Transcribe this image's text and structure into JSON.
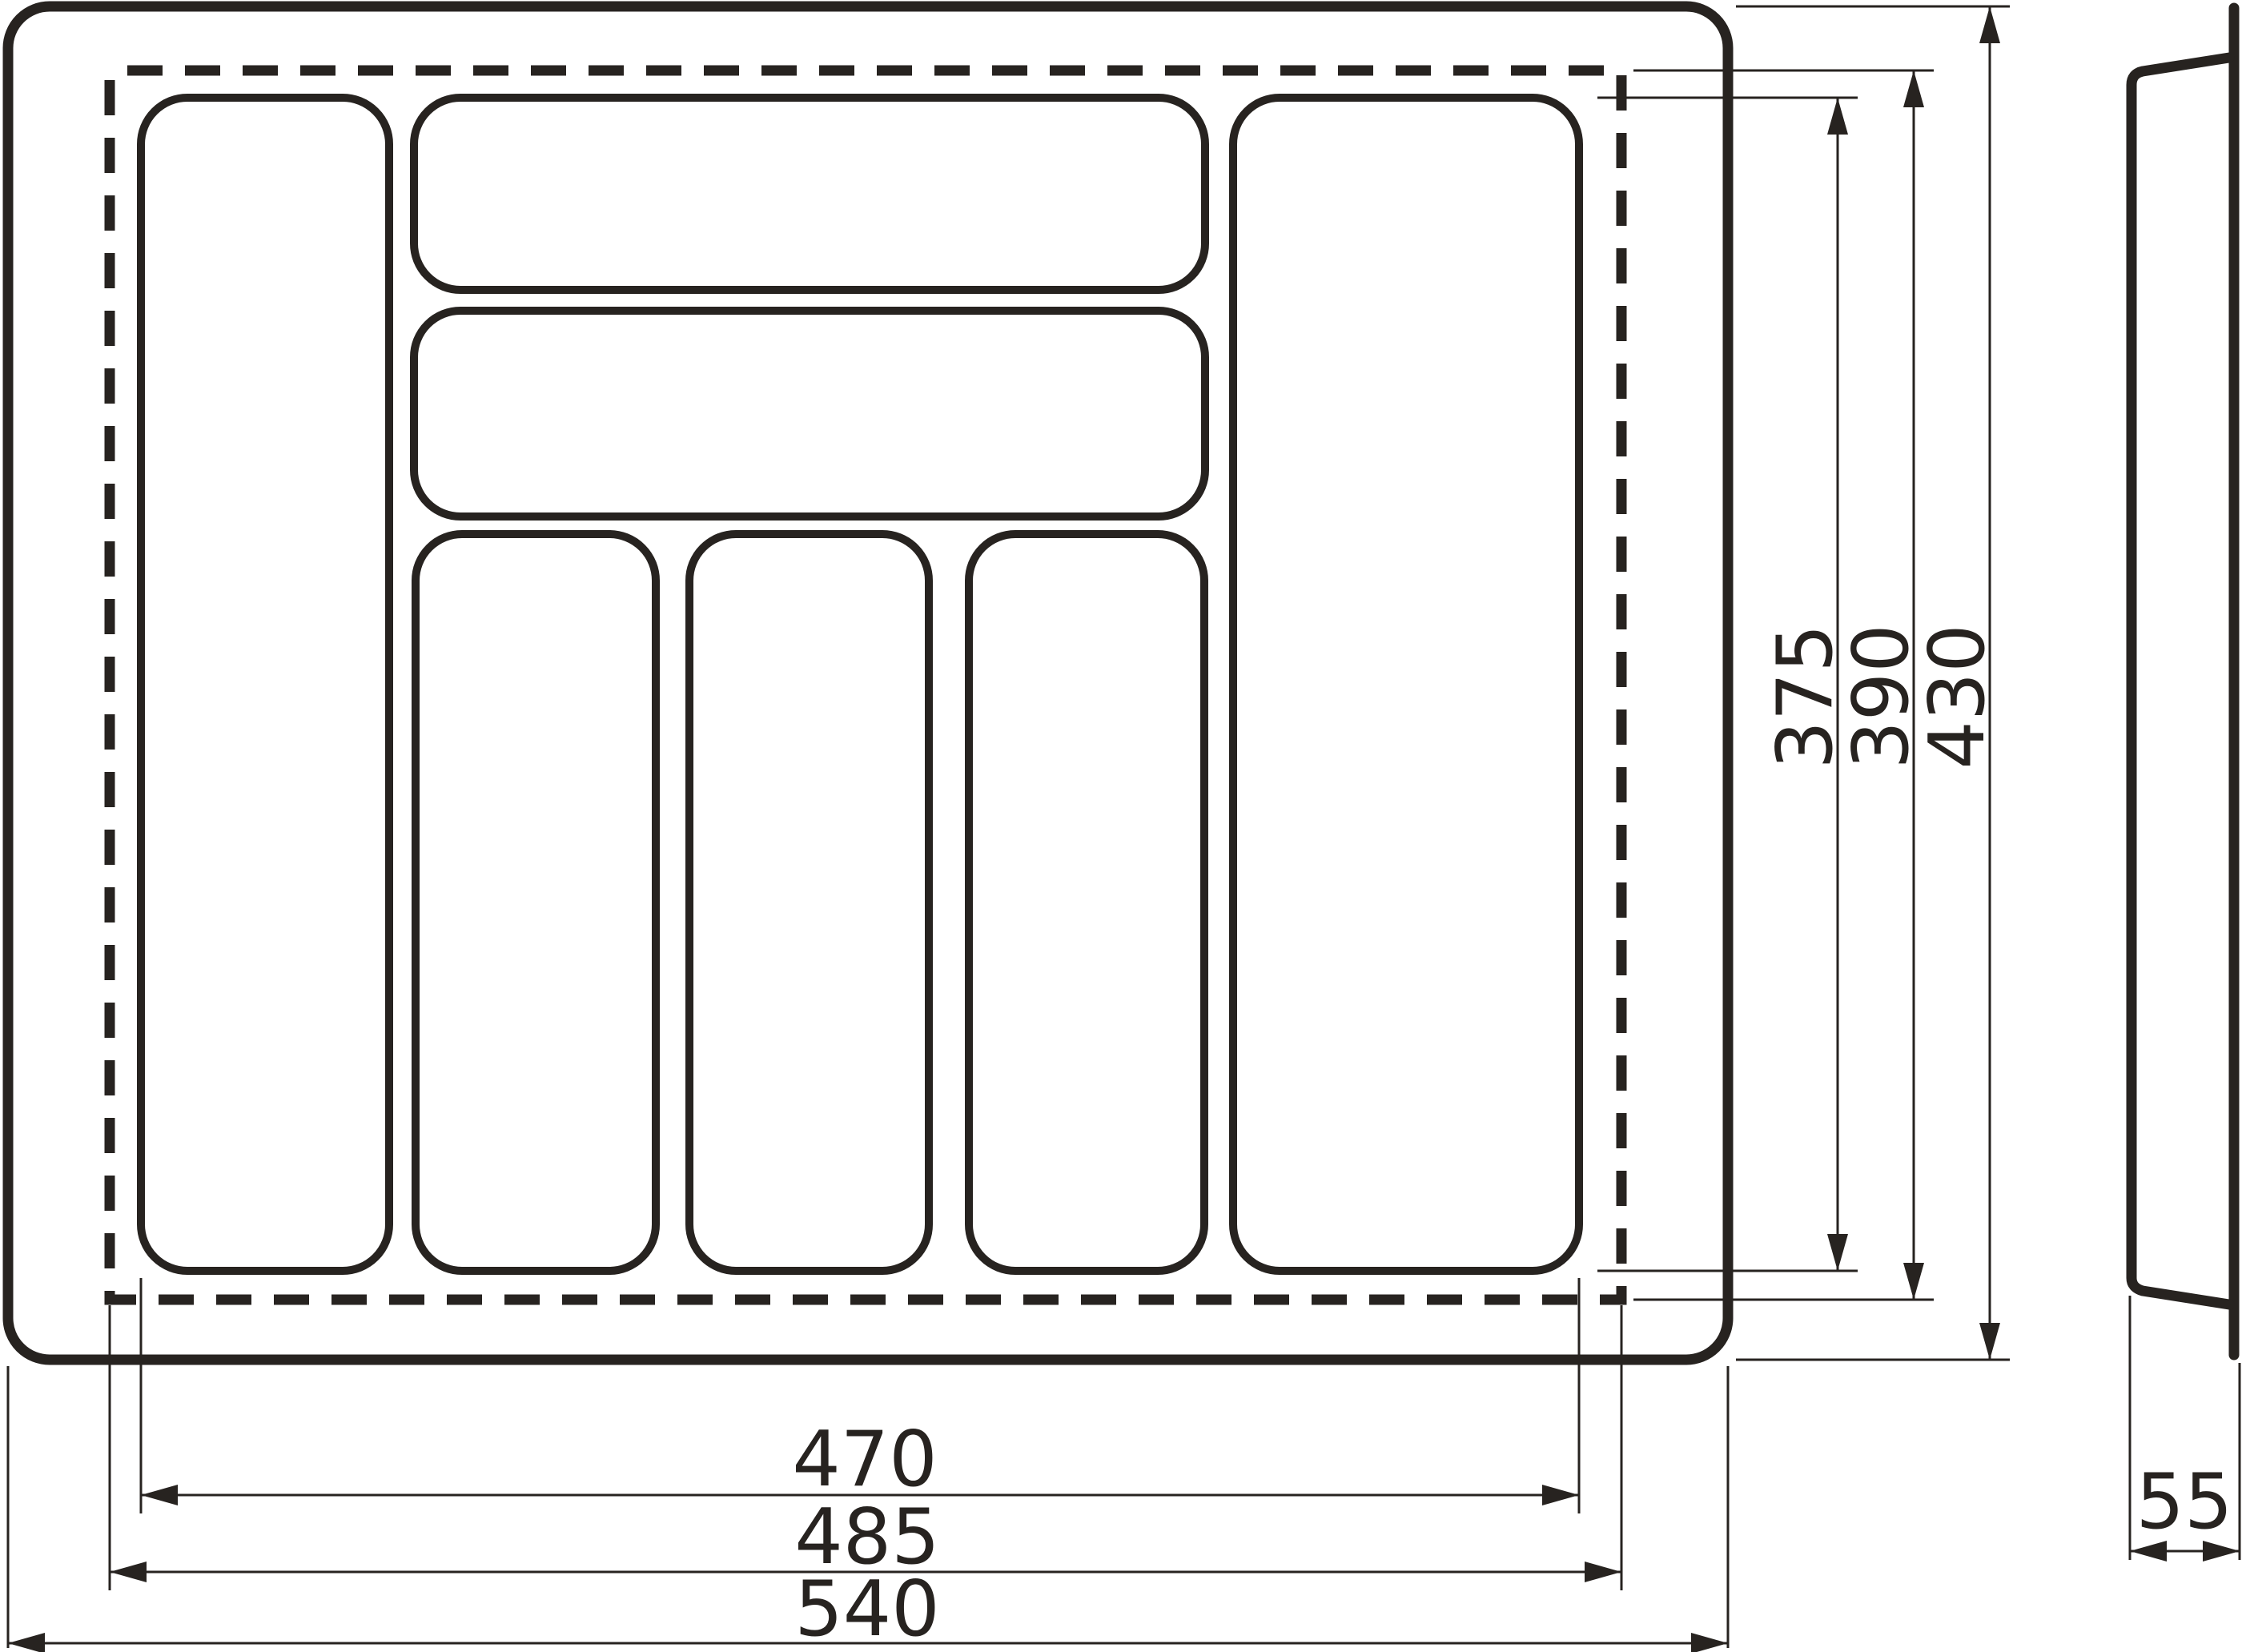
{
  "drawing": {
    "colors": {
      "line": "#272320",
      "background": "#ffffff"
    },
    "dims_horizontal": [
      {
        "label": "470"
      },
      {
        "label": "485"
      },
      {
        "label": "540"
      }
    ],
    "dims_vertical": [
      {
        "label": "375"
      },
      {
        "label": "390"
      },
      {
        "label": "430"
      }
    ],
    "dim_side": {
      "label": "55"
    }
  }
}
